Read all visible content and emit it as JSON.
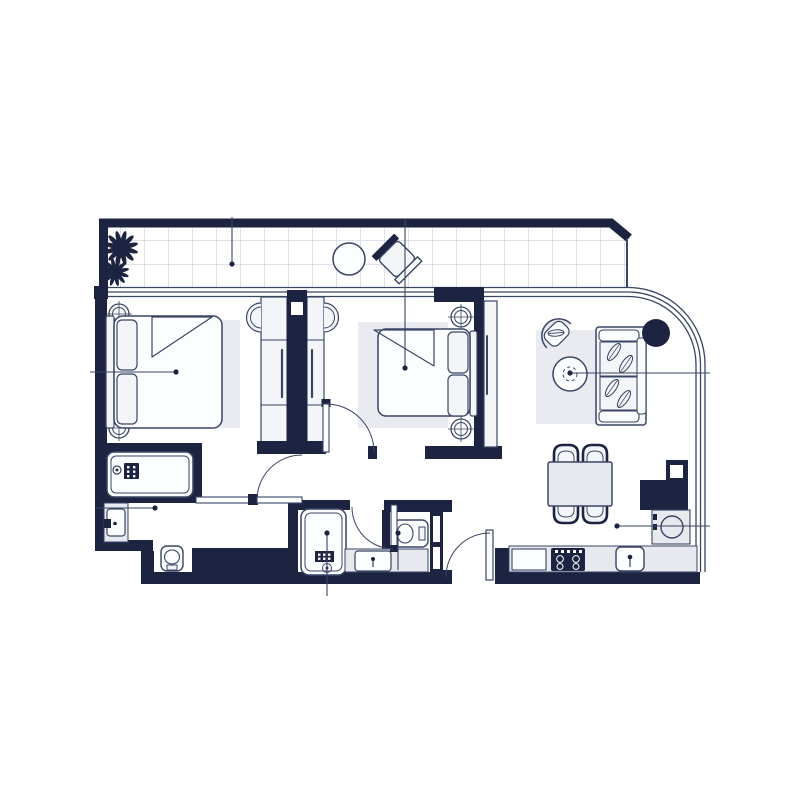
{
  "meta": {
    "type": "architectural-floor-plan",
    "description": "two-bedroom apartment floor plan with balcony, navy line-art style, no text labels",
    "canvas_width": 800,
    "canvas_height": 800
  },
  "palette": {
    "background": "#ffffff",
    "wall": "#1c2442",
    "line": "#3a4565",
    "fill_white": "#fcfdfe",
    "fill_light": "#e7e9ef",
    "fill_lighter": "#f4f5f9",
    "rug": "#e9ebf0",
    "grid_line": "#bcc3d4"
  },
  "rooms": [
    {
      "name": "balcony",
      "furniture": [
        "plants",
        "round-table",
        "lounge-chair"
      ],
      "floor": "tile-grid"
    },
    {
      "name": "bedroom-1",
      "furniture": [
        "double-bed",
        "two-pillows",
        "two-bedside-lamps",
        "rug",
        "wardrobe-left"
      ]
    },
    {
      "name": "bedroom-2",
      "furniture": [
        "double-bed",
        "two-pillows",
        "two-bedside-lamps",
        "rug",
        "wardrobe-right",
        "sliding-panel"
      ]
    },
    {
      "name": "living-dining",
      "furniture": [
        "sofa",
        "armchair",
        "round-coffee-table",
        "structural-column",
        "dining-table",
        "four-dining-chairs"
      ]
    },
    {
      "name": "kitchen",
      "furniture": [
        "counter",
        "stove-4-burners",
        "kitchen-sink",
        "round-appliance",
        "duct-column"
      ]
    },
    {
      "name": "bathroom-1",
      "furniture": [
        "bathtub",
        "vanity-sink",
        "toilet"
      ]
    },
    {
      "name": "bathroom-2",
      "furniture": [
        "shower",
        "vanity-sink"
      ]
    },
    {
      "name": "wc",
      "furniture": [
        "wall-hung-toilet",
        "niche-shelves"
      ]
    }
  ],
  "annotations": {
    "leader_lines_with_dots": 8,
    "doors": 4,
    "curved_glazing": "top-right corner, triple parallel lines"
  }
}
